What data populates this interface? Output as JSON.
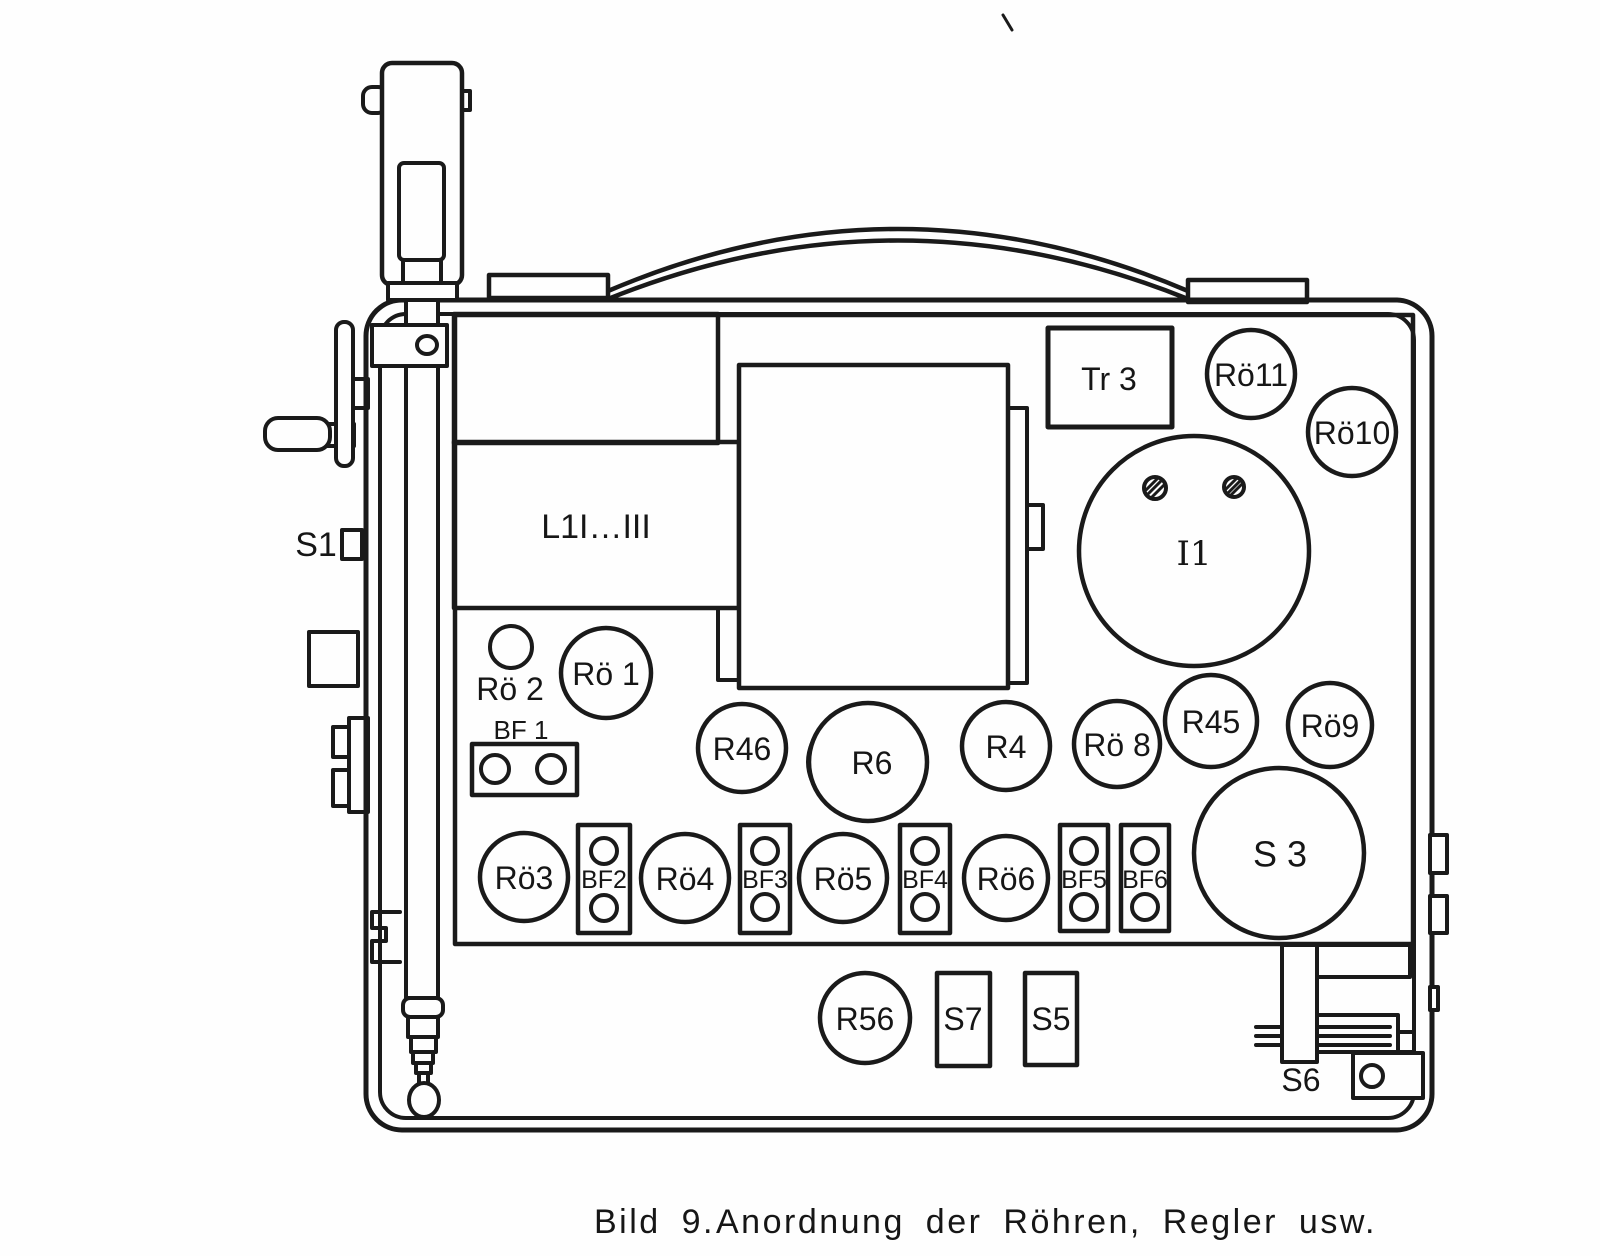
{
  "figure": {
    "caption_number": "Bild 9.",
    "caption_text": "Anordnung der Röhren, Regler usw.",
    "ink_color": "#1a1a1a",
    "paper_color": "#ffffff"
  },
  "labels": {
    "s1": "S1",
    "tr3": "Tr 3",
    "ro11": "Rö11",
    "ro10": "Rö10",
    "i1": "I1",
    "l1": "L1I…III",
    "ro2": "Rö 2",
    "ro1": "Rö 1",
    "bf1": "BF 1",
    "r46": "R46",
    "r6": "R6",
    "r4": "R4",
    "ro8": "Rö 8",
    "r45": "R45",
    "ro9": "Rö9",
    "s3": "S 3",
    "ro3": "Rö3",
    "bf2": "BF2",
    "ro4": "Rö4",
    "bf3": "BF3",
    "ro5": "Rö5",
    "bf4": "BF4",
    "ro6": "Rö6",
    "bf5": "BF5",
    "bf6": "BF6",
    "r56": "R56",
    "s7": "S7",
    "s5": "S5",
    "s6": "S6"
  }
}
